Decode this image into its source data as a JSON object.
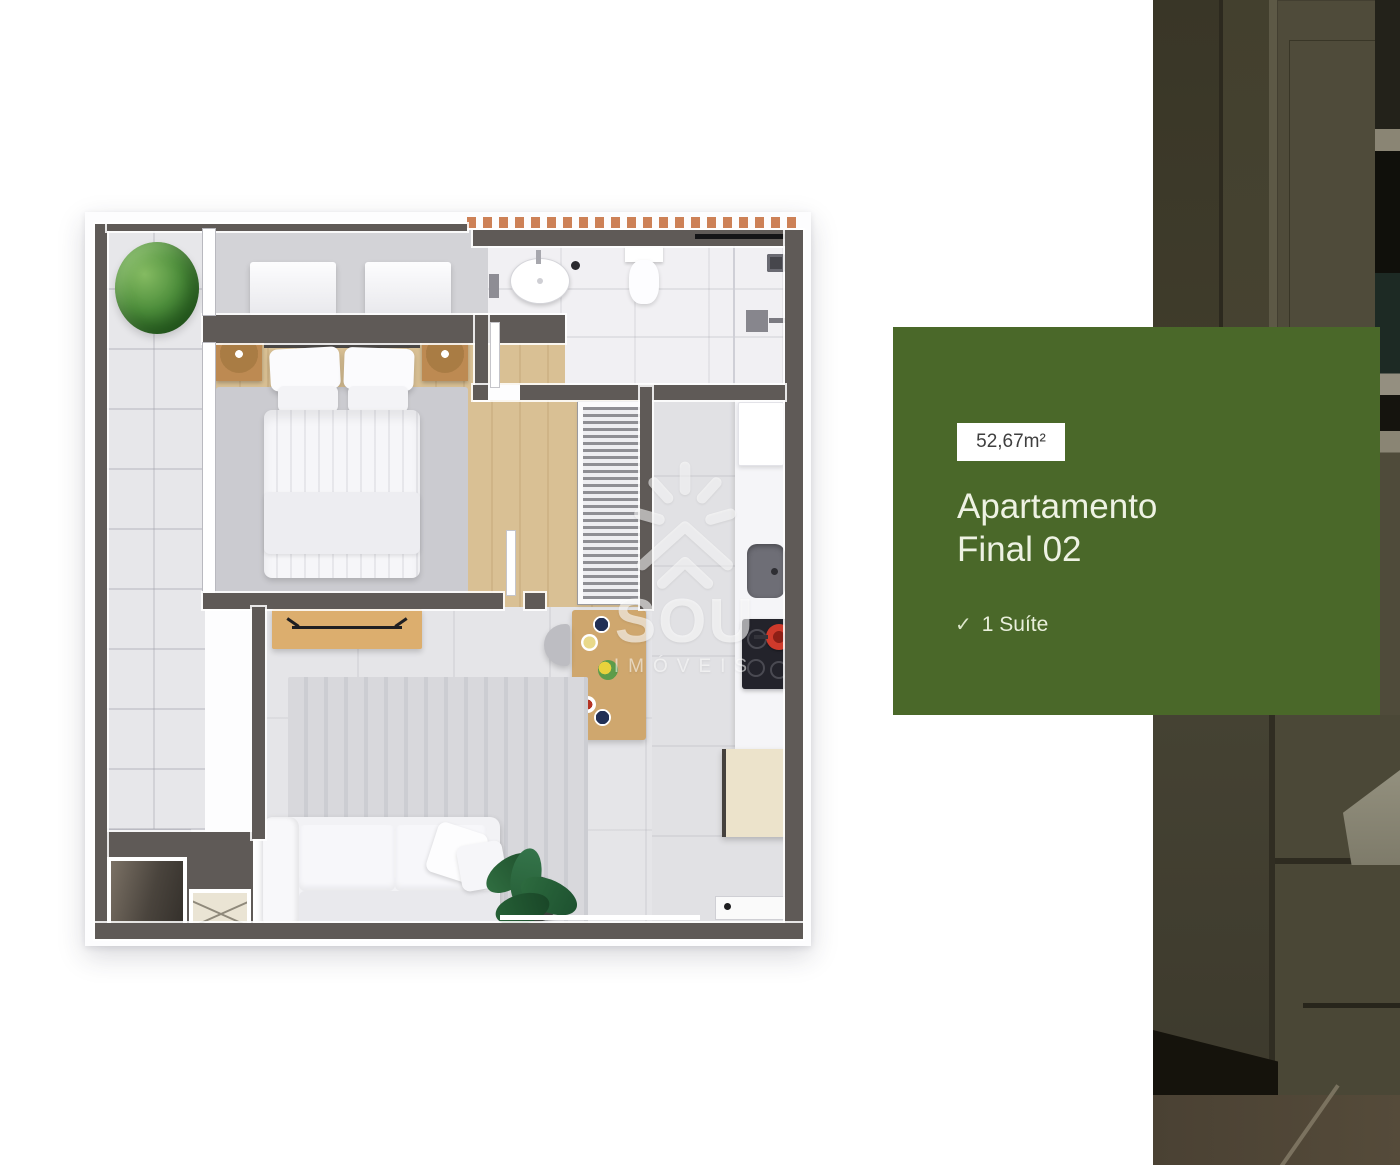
{
  "page": {
    "background_color": "#ffffff"
  },
  "unit_card": {
    "area_label": "52,67m²",
    "title_line1": "Apartamento",
    "title_line2": "Final 02",
    "features": [
      {
        "icon": "✓",
        "label": "1 Suíte"
      }
    ],
    "colors": {
      "card_background": "#4a6829",
      "badge_background": "#ffffff",
      "badge_text": "#3f3f3f",
      "text": "#eef2e3"
    }
  },
  "floorplan": {
    "watermark": {
      "brand": "SOU",
      "tagline": "IMÓVEIS"
    },
    "colors": {
      "wall": "#5f5a57",
      "roof_tile_accent": "#cd8157",
      "wood_floor": "#d9c094"
    }
  }
}
